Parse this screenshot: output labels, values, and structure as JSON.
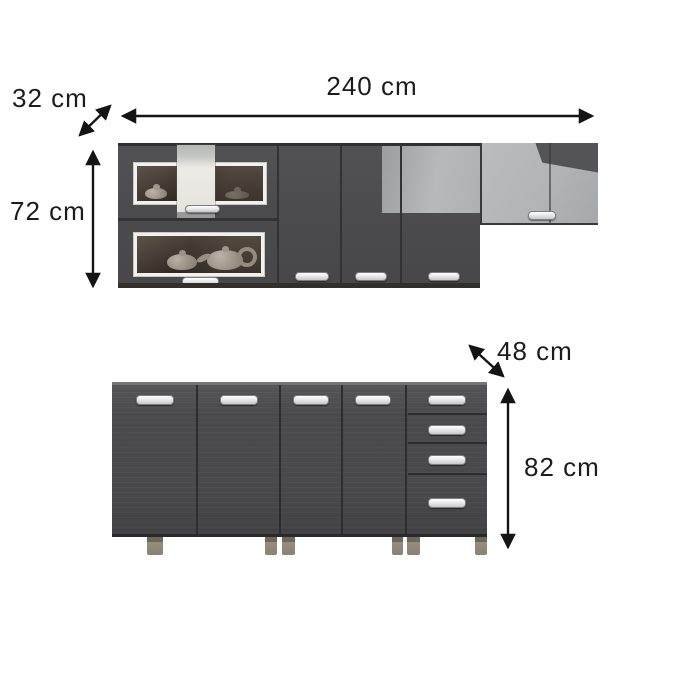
{
  "labels": {
    "upper_width": "240 cm",
    "upper_depth": "32 cm",
    "upper_height": "72 cm",
    "lower_depth": "48 cm",
    "lower_height": "82 cm"
  },
  "colors": {
    "cabinet_dark_gray": "#4b4b4d",
    "cabinet_light_gray": "#b3b5b7",
    "glass_interior_brown": "#3a322a",
    "door_frame_white": "#f2f1ee",
    "handle_white": "#ffffff",
    "leg_taupe": "#8d8577",
    "dimension_line_black": "#141414",
    "background": "#ffffff"
  }
}
